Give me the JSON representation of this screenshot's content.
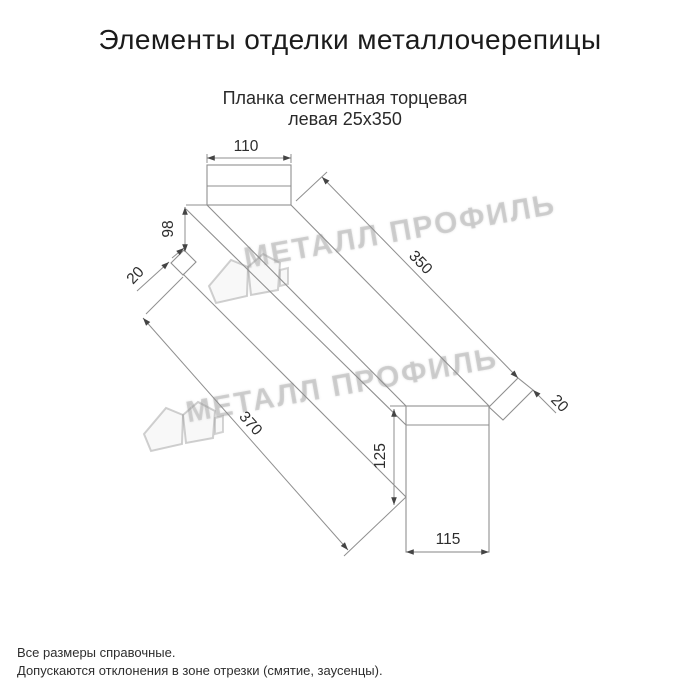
{
  "header": {
    "title": "Элементы отделки металлочерепицы"
  },
  "product": {
    "name_line1": "Планка сегментная торцевая",
    "name_line2": "левая 25x350"
  },
  "dimensions": {
    "top_width": "110",
    "left_height": "98",
    "left_hem": "20",
    "length_top": "350",
    "length_bottom": "370",
    "right_height": "125",
    "bottom_width": "115",
    "right_hem": "20"
  },
  "watermark": {
    "text": "МЕТАЛЛ ПРОФИЛЬ"
  },
  "footer": {
    "line1": "Все размеры справочные.",
    "line2": "Допускаются отклонения в зоне отрезки (смятие, заусенцы)."
  }
}
